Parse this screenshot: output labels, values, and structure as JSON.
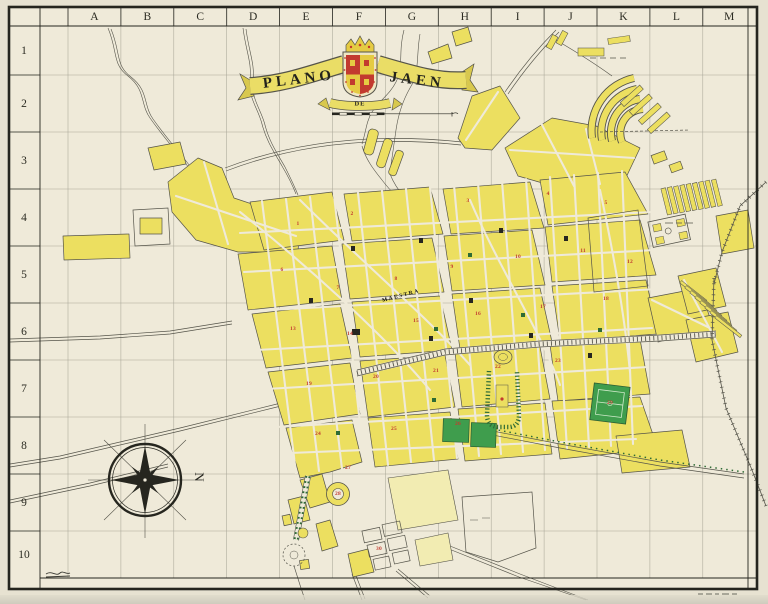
{
  "map": {
    "title": {
      "word_left": "PLANO",
      "word_middle": "DE",
      "word_right": "JAEN"
    },
    "grid": {
      "columns": [
        "A",
        "B",
        "C",
        "D",
        "E",
        "F",
        "G",
        "H",
        "I",
        "J",
        "K",
        "L",
        "M"
      ],
      "rows": [
        "1",
        "2",
        "3",
        "4",
        "5",
        "6",
        "7",
        "8",
        "9",
        "10"
      ]
    },
    "compass": {
      "north_label": "N"
    },
    "labels": {
      "street_main": "MAESTRA"
    },
    "block_markers": [
      {
        "n": "1",
        "x": 298,
        "y": 224
      },
      {
        "n": "2",
        "x": 352,
        "y": 214
      },
      {
        "n": "3",
        "x": 468,
        "y": 201
      },
      {
        "n": "4",
        "x": 548,
        "y": 194
      },
      {
        "n": "5",
        "x": 606,
        "y": 203
      },
      {
        "n": "6",
        "x": 282,
        "y": 270
      },
      {
        "n": "7",
        "x": 338,
        "y": 288
      },
      {
        "n": "8",
        "x": 396,
        "y": 279
      },
      {
        "n": "9",
        "x": 452,
        "y": 267
      },
      {
        "n": "10",
        "x": 518,
        "y": 257
      },
      {
        "n": "11",
        "x": 583,
        "y": 251
      },
      {
        "n": "12",
        "x": 630,
        "y": 262
      },
      {
        "n": "13",
        "x": 293,
        "y": 329
      },
      {
        "n": "14",
        "x": 350,
        "y": 334
      },
      {
        "n": "15",
        "x": 416,
        "y": 321
      },
      {
        "n": "16",
        "x": 478,
        "y": 314
      },
      {
        "n": "17",
        "x": 543,
        "y": 307
      },
      {
        "n": "18",
        "x": 606,
        "y": 299
      },
      {
        "n": "19",
        "x": 309,
        "y": 384
      },
      {
        "n": "20",
        "x": 376,
        "y": 377
      },
      {
        "n": "21",
        "x": 436,
        "y": 371
      },
      {
        "n": "22",
        "x": 498,
        "y": 367
      },
      {
        "n": "23",
        "x": 558,
        "y": 361
      },
      {
        "n": "24",
        "x": 318,
        "y": 434
      },
      {
        "n": "25",
        "x": 394,
        "y": 429
      },
      {
        "n": "26",
        "x": 458,
        "y": 424
      },
      {
        "n": "27",
        "x": 348,
        "y": 468
      },
      {
        "n": "28",
        "x": 338,
        "y": 494
      },
      {
        "n": "29",
        "x": 610,
        "y": 403
      },
      {
        "n": "30",
        "x": 379,
        "y": 549
      }
    ],
    "colors": {
      "paper_outer": "#e7e2d1",
      "paper_map": "#efead9",
      "band": "#f0ecdd",
      "frame": "#25251e",
      "grid": "#7c7b6e",
      "block": "#ecdf60",
      "block_pale": "#f2ecb2",
      "outline": "#55544a",
      "park": "#3f9d4d",
      "park_dark": "#2e6b35",
      "red": "#c23a2f",
      "gold": "#e5cb43",
      "ink": "#2b2b22"
    }
  }
}
